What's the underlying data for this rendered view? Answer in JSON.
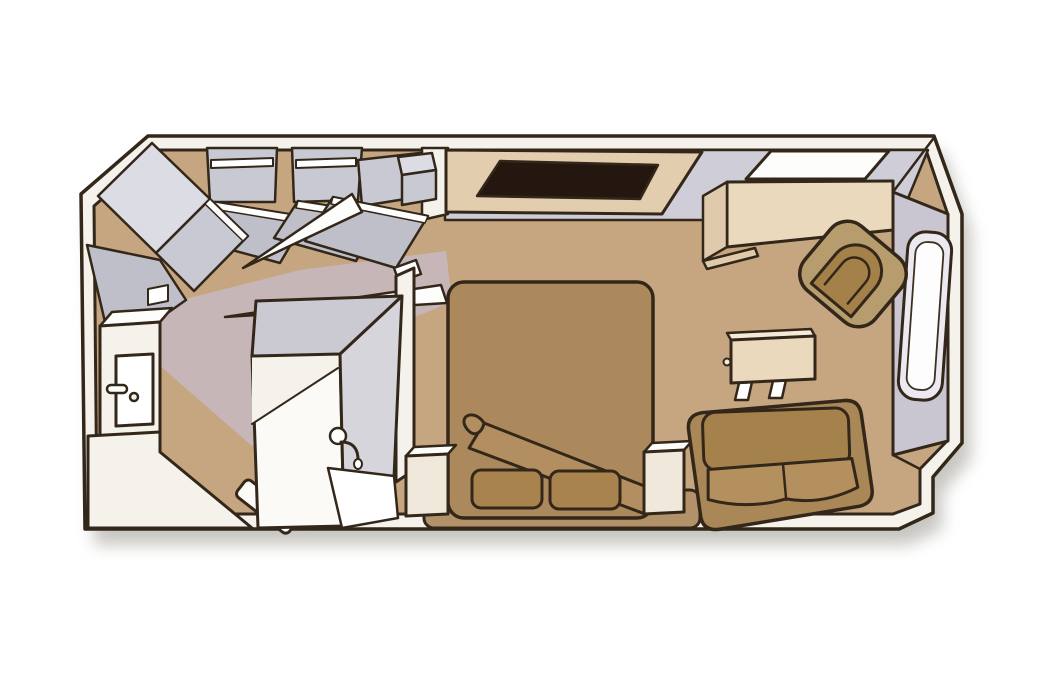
{
  "scene": {
    "type": "floor-plan",
    "description": "Isometric cutaway floor plan of a cruise-ship stateroom; no text labels are rendered in the drawing",
    "rooms": [
      "bathroom",
      "entry-vestibule",
      "wardrobe-area",
      "sleeping-area",
      "sitting-area"
    ],
    "furniture": [
      {
        "id": "wardrobe-corner",
        "label": "corner wardrobe with open angled doors"
      },
      {
        "id": "wardrobe-1",
        "label": "open wardrobe with hanging rod"
      },
      {
        "id": "wardrobe-2",
        "label": "open wardrobe with hanging rod"
      },
      {
        "id": "cabinet",
        "label": "small cabinet with open door"
      },
      {
        "id": "vanity-desk",
        "label": "desk with dark inlay top"
      },
      {
        "id": "counter",
        "label": "counter / cabinet unit"
      },
      {
        "id": "armchair",
        "label": "rounded armchair set at an angle"
      },
      {
        "id": "side-table",
        "label": "small side table with legs"
      },
      {
        "id": "bed",
        "label": "double bed with folded blanket corner"
      },
      {
        "id": "pillow-left",
        "label": "pillow"
      },
      {
        "id": "pillow-right",
        "label": "pillow"
      },
      {
        "id": "nightstand-left",
        "label": "nightstand"
      },
      {
        "id": "nightstand-right",
        "label": "nightstand"
      },
      {
        "id": "sofa",
        "label": "two-seat sofa"
      },
      {
        "id": "entry-door",
        "label": "entry door with handle"
      },
      {
        "id": "toilet",
        "label": "toilet"
      },
      {
        "id": "shower",
        "label": "shower enclosure with shower head"
      },
      {
        "id": "window",
        "label": "window on outer wall"
      }
    ]
  },
  "colors": {
    "page_bg": "#ffffff",
    "outline": "#33271a",
    "floor": "#c5a681",
    "floor_tint": "#c6bac6",
    "wall_white": "#f5f2ec",
    "wall_top": "#fdfdfc",
    "band_gray": "#cfced8",
    "closet_light": "#dcdce4",
    "closet_mid": "#c9c9d3",
    "closet_dark": "#bfbfca",
    "lavender_wall": "#c9c5d1",
    "window_frame": "#eceaf0",
    "white": "#ffffff",
    "bed": "#ac895c",
    "bed_base": "#b3926a",
    "fold": "#b28e60",
    "pillow": "#a8834d",
    "sofa_body": "#aa8756",
    "sofa_back": "#a5824c",
    "sofa_seat": "#b3905e",
    "chair_outer": "#b79c6d",
    "chair_inner": "#a5814a",
    "beige": "#ead9bd",
    "beige_dark": "#dfcbab",
    "beige_light": "#f4ead8",
    "cream": "#f0e8da",
    "desk_top": "#e3cdaf",
    "desk_dark": "#241710",
    "fixture_white": "#fbfaf6",
    "shower_side": "#d6d5dc",
    "shower_top": "#cbcad3",
    "shadow": "#9a978f"
  }
}
